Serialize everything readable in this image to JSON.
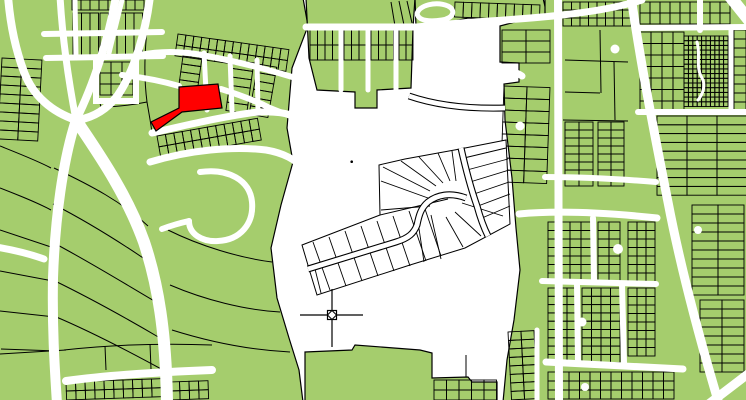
{
  "map": {
    "width": 746,
    "height": 400,
    "colors": {
      "background": "#ffffff",
      "parcel_fill": "#a5cd6d",
      "parcel_outline": "#000000",
      "road": "#ffffff",
      "highlight": "#ff0000",
      "plat_fill": "#ffffff"
    },
    "zones": [
      {
        "name": "left-parcel-zone",
        "points": "-2,-2 303,-2 308,26 292,68 287,128 293,162 281,205 271,248 277,298 289,338 299,370 303,402 -2,402"
      },
      {
        "name": "top-middle-parcel-zone",
        "points": "306,-2 415,-2 413,28 411,88 377,90 377,108 355,108 355,92 317,90 309,58"
      },
      {
        "name": "top-strip-parcel-zone",
        "points": "415,-2 543,-2 547,15 517,23 468,18 441,24 416,27"
      },
      {
        "name": "right-parcel-zone",
        "points": "500,26 545,14 545,-2 748,-2 748,402 503,402 507,360 514,320 520,270 516,228 512,178 505,120 504,84 519,82 519,63 500,62"
      },
      {
        "name": "bottom-middle-parcel-zone",
        "points": "305,352 352,350 355,345 420,350 432,353 432,378 468,377 472,382 497,382 497,402 305,402"
      }
    ],
    "grids": [
      {
        "name": "lots-topleft-a",
        "x": 73,
        "y": 13,
        "rows": 2,
        "cols": 3,
        "cw": 8.5,
        "ch": 21,
        "angle": 0
      },
      {
        "name": "lots-topleft-b",
        "x": 100,
        "y": 13,
        "rows": 2,
        "cols": 5,
        "cw": 8.5,
        "ch": 21,
        "angle": 0
      },
      {
        "name": "lots-topleft-c",
        "x": 72,
        "y": 0,
        "rows": 1,
        "cols": 8,
        "cw": 9,
        "ch": 10,
        "angle": 0
      },
      {
        "name": "lots-loop-block",
        "x": 100,
        "y": 62,
        "rows": 3,
        "cols": 3,
        "cw": 11,
        "ch": 11,
        "angle": 0
      },
      {
        "name": "lots-ne-of-junction",
        "x": 178,
        "y": 34,
        "rows": 2,
        "cols": 14,
        "cw": 8,
        "ch": 11,
        "angle": 8
      },
      {
        "name": "lots-col-a",
        "x": 183,
        "y": 56,
        "rows": 4,
        "cols": 1,
        "cw": 19,
        "ch": 8,
        "angle": 8
      },
      {
        "name": "lots-col-b",
        "x": 233,
        "y": 60,
        "rows": 6,
        "cols": 1,
        "cw": 21,
        "ch": 8.5,
        "angle": 8
      },
      {
        "name": "lots-col-c",
        "x": 258,
        "y": 64,
        "rows": 6,
        "cols": 1,
        "cw": 19,
        "ch": 8.5,
        "angle": 10
      },
      {
        "name": "lots-below-red",
        "x": 157,
        "y": 136,
        "rows": 2,
        "cols": 12,
        "cw": 8.5,
        "ch": 11,
        "angle": -10
      },
      {
        "name": "lots-bottomleft",
        "x": 66,
        "y": 382,
        "rows": 2,
        "cols": 10,
        "cw": 9.5,
        "ch": 9,
        "angle": -2
      },
      {
        "name": "lots-bottomleft-b",
        "x": 170,
        "y": 382,
        "rows": 2,
        "cols": 4,
        "cw": 9.5,
        "ch": 9,
        "angle": -2
      },
      {
        "name": "lots-left-edge",
        "x": 2,
        "y": 58,
        "rows": 9,
        "cols": 2,
        "cw": 20,
        "ch": 9,
        "angle": 3
      },
      {
        "name": "lots-topmid-1",
        "x": 310,
        "y": 30,
        "rows": 2,
        "cols": 4,
        "cw": 7.5,
        "ch": 15,
        "angle": 0
      },
      {
        "name": "lots-topmid-2",
        "x": 344,
        "y": 30,
        "rows": 2,
        "cols": 3,
        "cw": 7.5,
        "ch": 15,
        "angle": 0
      },
      {
        "name": "lots-topmid-3",
        "x": 371,
        "y": 30,
        "rows": 2,
        "cols": 3,
        "cw": 7.5,
        "ch": 15,
        "angle": 0
      },
      {
        "name": "lots-topmid-4",
        "x": 399,
        "y": 30,
        "rows": 2,
        "cols": 2,
        "cw": 7,
        "ch": 15,
        "angle": 0
      },
      {
        "name": "lots-topstrip",
        "x": 455,
        "y": 2,
        "rows": 1,
        "cols": 10,
        "cw": 8.5,
        "ch": 15,
        "angle": 2
      },
      {
        "name": "lots-right-top",
        "x": 563,
        "y": 2,
        "rows": 3,
        "cols": 8,
        "cw": 8.5,
        "ch": 8,
        "angle": 0
      },
      {
        "name": "lots-right-mid-a",
        "x": 565,
        "y": 122,
        "rows": 8,
        "cols": 2,
        "cw": 14,
        "ch": 8,
        "angle": 0
      },
      {
        "name": "lots-right-mid-b",
        "x": 598,
        "y": 122,
        "rows": 8,
        "cols": 2,
        "cw": 13,
        "ch": 8,
        "angle": 0
      },
      {
        "name": "lots-right-strips",
        "x": 657,
        "y": 116,
        "rows": 9,
        "cols": 3,
        "cw": 30,
        "ch": 8.8,
        "angle": 0
      },
      {
        "name": "lots-right-notch",
        "x": 502,
        "y": 30,
        "rows": 3,
        "cols": 2,
        "cw": 24,
        "ch": 11,
        "angle": 0
      },
      {
        "name": "lots-right-col",
        "x": 504,
        "y": 86,
        "rows": 8,
        "cols": 2,
        "cw": 23,
        "ch": 12,
        "angle": 2
      },
      {
        "name": "lots-rb-1",
        "x": 548,
        "y": 222,
        "rows": 7,
        "cols": 4,
        "cw": 11,
        "ch": 8.5,
        "angle": 0
      },
      {
        "name": "lots-rb-2",
        "x": 598,
        "y": 222,
        "rows": 7,
        "cols": 2,
        "cw": 11,
        "ch": 8.5,
        "angle": 0
      },
      {
        "name": "lots-rb-3",
        "x": 628,
        "y": 222,
        "rows": 7,
        "cols": 3,
        "cw": 9,
        "ch": 8.5,
        "angle": 0
      },
      {
        "name": "lots-rb-4",
        "x": 548,
        "y": 288,
        "rows": 9,
        "cols": 3,
        "cw": 9.5,
        "ch": 8.3,
        "angle": 0
      },
      {
        "name": "lots-rb-5",
        "x": 582,
        "y": 288,
        "rows": 9,
        "cols": 4,
        "cw": 9.5,
        "ch": 8.3,
        "angle": 0
      },
      {
        "name": "lots-rb-6",
        "x": 628,
        "y": 288,
        "rows": 8,
        "cols": 3,
        "cw": 9,
        "ch": 8.5,
        "angle": 0
      },
      {
        "name": "lots-rb-bottom",
        "x": 548,
        "y": 372,
        "rows": 3,
        "cols": 12,
        "cw": 10.5,
        "ch": 9,
        "angle": 0
      },
      {
        "name": "lots-rb-east",
        "x": 692,
        "y": 205,
        "rows": 10,
        "cols": 2,
        "cw": 26,
        "ch": 9,
        "angle": 0
      },
      {
        "name": "lots-rb-east2",
        "x": 700,
        "y": 300,
        "rows": 8,
        "cols": 2,
        "cw": 22,
        "ch": 9,
        "angle": 0
      },
      {
        "name": "lots-rt-east",
        "x": 640,
        "y": 32,
        "rows": 7,
        "cols": 4,
        "cw": 11,
        "ch": 11.5,
        "angle": 0
      },
      {
        "name": "lots-rt-far",
        "x": 734,
        "y": 30,
        "rows": 9,
        "cols": 1,
        "cw": 12,
        "ch": 9,
        "angle": 0
      },
      {
        "name": "lots-rt-top",
        "x": 640,
        "y": 2,
        "rows": 2,
        "cols": 9,
        "cw": 10,
        "ch": 11,
        "angle": 0
      },
      {
        "name": "lots-maze-block",
        "x": 684,
        "y": 36,
        "rows": 15,
        "cols": 10,
        "cw": 4.4,
        "ch": 4.7,
        "angle": 0
      },
      {
        "name": "lots-taper-col",
        "x": 508,
        "y": 332,
        "rows": 8,
        "cols": 2,
        "cw": 13,
        "ch": 8.5,
        "angle": -3
      },
      {
        "name": "lots-bottommid",
        "x": 434,
        "y": 380,
        "rows": 2,
        "cols": 5,
        "cw": 12.5,
        "ch": 10,
        "angle": 0
      }
    ],
    "parcel_lines": [
      "M0,146 C20,154 38,161 51,168",
      "M0,188 C18,195 36,202 51,210",
      "M0,230 L51,247",
      "M0,271 L53,281",
      "M0,311 L55,317",
      "M1,349 L57,351",
      "M54,168 C92,186 122,202 148,226",
      "M53,204 C88,222 120,242 152,264",
      "M52,242 C88,261 122,282 156,302",
      "M53,280 C90,298 126,318 160,338",
      "M54,316 C92,332 130,352 163,370",
      "M150,2 C145,42 143,72 147,102 C149,114 151,124 152,133",
      "M147,102 C132,105 116,107 101,107",
      "M101,107 C96,90 94,70 96,58",
      "M168,230 C200,246 240,258 272,262",
      "M170,285 C205,300 245,310 280,312",
      "M172,330 C210,342 250,350 290,352",
      "M0,354 L66,350",
      "M64,350 C110,345 162,343 212,345",
      "M105,346 L106,370",
      "M150,344 L151,369",
      "M399,1 L404,25",
      "M407,1 L412,23",
      "M391,2 L395,26",
      "M565,60 L628,62",
      "M565,92 L600,93",
      "M600,30 L601,93",
      "M614,62 L615,120",
      "M563,120 L628,121",
      "M432,353 L432,378",
      "M466,355 L466,377"
    ],
    "roads": [
      {
        "name": "road-nw-1",
        "d": "M8,-4 C10,22 15,48 24,72 C33,96 52,112 76,120",
        "w": 8
      },
      {
        "name": "road-nw-2",
        "d": "M60,-4 C62,32 68,78 76,120",
        "w": 7
      },
      {
        "name": "road-nw-3",
        "d": "M116,-4 C109,38 93,86 76,120",
        "w": 8
      },
      {
        "name": "road-sw-main",
        "d": "M76,120 C63,160 55,218 53,278 C52,330 55,372 57,404",
        "w": 10
      },
      {
        "name": "road-s-main",
        "d": "M76,120 C96,150 126,192 144,242 C158,284 166,332 167,404",
        "w": 12
      },
      {
        "name": "road-diag-top",
        "d": "M150,-4 C146,30 135,70 118,95 C105,112 90,118 78,120",
        "w": 8
      },
      {
        "name": "road-ne-collector",
        "d": "M140,55 C165,50 188,52 207,56 C240,62 270,70 302,80",
        "w": 6
      },
      {
        "name": "road-above-red",
        "d": "M122,75 C140,77 162,81 179,86",
        "w": 6
      },
      {
        "name": "road-east-of-red",
        "d": "M221,89 C240,95 258,102 270,108 C282,113 294,117 302,121",
        "w": 6
      },
      {
        "name": "road-below-red",
        "d": "M152,133 C182,126 216,118 250,113 C272,110 290,113 302,119",
        "w": 7
      },
      {
        "name": "road-below-red-2",
        "d": "M150,162 C190,150 232,146 266,150 C284,153 296,160 302,168",
        "w": 7
      },
      {
        "name": "street-col-a",
        "d": "M204,53 L207,110",
        "w": 5
      },
      {
        "name": "street-col-b",
        "d": "M230,56 L232,111",
        "w": 5
      },
      {
        "name": "street-col-c",
        "d": "M257,60 L258,112",
        "w": 5
      },
      {
        "name": "street-hook",
        "d": "M200,172 C228,168 250,180 252,202 C254,224 240,240 218,241 C202,242 189,234 189,221",
        "w": 6
      },
      {
        "name": "street-hook-stub",
        "d": "M189,221 C180,223 170,226 162,229",
        "w": 6
      },
      {
        "name": "road-bottomleft",
        "d": "M66,381 C110,375 160,372 212,370",
        "w": 8
      },
      {
        "name": "road-left-edge",
        "d": "M-4,247 C14,250 30,254 44,259",
        "w": 7
      },
      {
        "name": "street-grid-h1",
        "d": "M44,34 L162,32",
        "w": 6
      },
      {
        "name": "street-grid-h2",
        "d": "M46,58 L163,56",
        "w": 6
      },
      {
        "name": "street-grid-v1",
        "d": "M75,0 L76,57",
        "w": 5
      },
      {
        "name": "street-grid-v2",
        "d": "M122,0 L108,57",
        "w": 5
      },
      {
        "name": "street-block-loop",
        "d": "M96,58 L96,101 L136,101 L136,58",
        "w": 6
      },
      {
        "name": "road-topmid-collector",
        "d": "M306,27 L417,27 C460,22 520,20 562,15 C600,11 626,5 642,0",
        "w": 7
      },
      {
        "name": "street-topmid-v1",
        "d": "M341,27 L341,90",
        "w": 5
      },
      {
        "name": "street-topmid-v2",
        "d": "M368,27 L368,90",
        "w": 5
      },
      {
        "name": "street-topmid-v3",
        "d": "M396,27 L396,90",
        "w": 5
      },
      {
        "name": "street-culdesac-loop",
        "d": "M417,14 C419,5 436,1 448,6 C456,10 454,18 442,20 C430,22 419,21 417,14",
        "w": 5
      },
      {
        "name": "road-right-v1",
        "d": "M558,-4 L559,404",
        "w": 8
      },
      {
        "name": "road-right-diagonal",
        "d": "M631,-4 C640,60 654,132 668,202 C681,270 700,340 719,404",
        "w": 9
      },
      {
        "name": "road-corner-ne",
        "d": "M728,-6 L752,24",
        "w": 12
      },
      {
        "name": "road-corner-se",
        "d": "M706,406 L748,374",
        "w": 9
      },
      {
        "name": "road-right-h1",
        "d": "M519,214 C560,210 610,213 657,218",
        "w": 7
      },
      {
        "name": "road-right-h2",
        "d": "M545,177 C580,177 620,179 656,182",
        "w": 6
      },
      {
        "name": "road-right-h3",
        "d": "M542,281 L656,284",
        "w": 6
      },
      {
        "name": "road-right-h4",
        "d": "M546,362 L683,369",
        "w": 7
      },
      {
        "name": "street-right-v2",
        "d": "M593,218 L594,281",
        "w": 6
      },
      {
        "name": "street-right-v3",
        "d": "M622,284 L624,363",
        "w": 6
      },
      {
        "name": "street-right-v4",
        "d": "M577,284 L578,362",
        "w": 6
      },
      {
        "name": "street-right-v5",
        "d": "M537,330 L537,404",
        "w": 5
      },
      {
        "name": "road-rt-h1",
        "d": "M636,28 L750,27",
        "w": 6
      },
      {
        "name": "road-rt-h2",
        "d": "M638,112 L750,112",
        "w": 6
      },
      {
        "name": "street-rt-v1",
        "d": "M731,30 L731,112",
        "w": 5
      },
      {
        "name": "street-rt-v2",
        "d": "M700,-4 L700,30",
        "w": 6
      },
      {
        "name": "road-notch-stub",
        "d": "M497,66 C507,69 516,72 522,76",
        "w": 7
      },
      {
        "name": "street-maze-squiggle",
        "d": "M697,42 C701,55 695,66 702,78 C706,85 703,94 698,100",
        "w": 3
      }
    ],
    "outlined_roads": [
      {
        "name": "road-white-area-stub",
        "d": "M409,96 C438,106 470,109 505,108",
        "w": 7
      }
    ],
    "culdesacs": [
      [
        615,
        49,
        4.5
      ],
      [
        520,
        126,
        4.5
      ],
      [
        618,
        249,
        5
      ],
      [
        582,
        322,
        4.5
      ],
      [
        698,
        230,
        4
      ],
      [
        585,
        387,
        4
      ]
    ],
    "point_dot": [
      351.7,
      161.7
    ],
    "plat": {
      "outline": "302,245 380,215 379,165 405,159 460,149 506,140 510,224 465,248 410,265 317,295 310,272",
      "lines": [
        "M380,215 L448,199",
        "M313,242 L330,290",
        "M329,237 L346,286",
        "M345,231 L362,281",
        "M361,226 L378,276",
        "M377,221 L394,271",
        "M393,216 L410,266",
        "M409,211 L426,261",
        "M424,206 L441,256",
        "M315,269 L321,293",
        "M430,206 L381,210",
        "M428,198 L381,181",
        "M430,191 L383,167",
        "M436,186 L401,161",
        "M443,183 L419,157",
        "M450,181 L438,153",
        "M456,181 L452,151",
        "M464,158 L506,148",
        "M467,170 L508,159",
        "M470,182 L509,170",
        "M474,194 L509,182",
        "M478,206 L510,194",
        "M482,218 L510,206",
        "M462,203 L503,216",
        "M455,212 L481,236",
        "M446,217 L463,247",
        "M431,215 L441,259",
        "M418,222 L424,262"
      ],
      "roads": [
        {
          "name": "plat-road-curve",
          "d": "M308,269 L396,242 C409,238 414,233 417,225 C419,215 421,208 428,202 C437,195 450,192 466,198",
          "w": 7
        },
        {
          "name": "plat-road-diagonal",
          "d": "M461,148 C465,166 470,186 477,206 C480,217 484,228 488,236",
          "w": 7
        }
      ]
    },
    "highlight_parcel": {
      "points": "179,87 218,84 222,108 182,112 156,131 151,122 179,108"
    },
    "marker": {
      "h_line": "M300,315 L363,315",
      "v_line": "M332,289 L332,347",
      "box": [
        327.5,
        310.5,
        9,
        9
      ],
      "diamond": "332,310.5 336.5,315 332,319.5 327.5,315"
    }
  }
}
